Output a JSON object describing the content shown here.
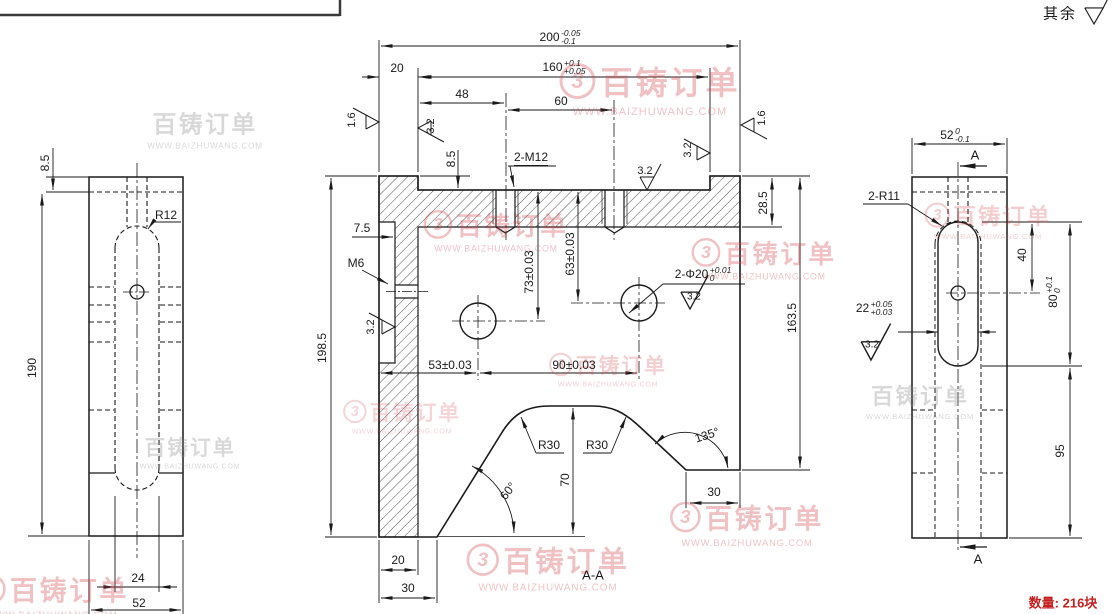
{
  "note": {
    "text": "其余"
  },
  "quantity": {
    "label": "数量: 216块"
  },
  "watermark": {
    "brand": "百铸订单",
    "url": "WWW.BAIZHUWANG.COM",
    "logo": "3"
  },
  "left_view": {
    "dim_8_5": "8.5",
    "dim_190": "190",
    "label_r12": "R12",
    "dim_24": "24",
    "dim_52": "52"
  },
  "main_view": {
    "dim_200": {
      "v": "200",
      "t1": "-0.05",
      "t2": "-0.1"
    },
    "dim_160": {
      "v": "160",
      "t1": "+0.1",
      "t2": "+0.05"
    },
    "dim_20_top": "20",
    "dim_48": "48",
    "dim_60": "60",
    "label_2m12": "2-M12",
    "dim_8_5": "8.5",
    "dim_28_5": "28.5",
    "dim_163_5": "163.5",
    "dim_198_5": "198.5",
    "dim_7_5": "7.5",
    "label_m6": "M6",
    "dim_73": "73±0.03",
    "dim_63": "63±0.03",
    "label_2phi20": {
      "v": "2-Φ20",
      "t1": "+0.01",
      "t2": "0"
    },
    "dim_53": "53±0.03",
    "dim_90": "90±0.03",
    "label_r30_1": "R30",
    "label_r30_2": "R30",
    "dim_60deg": "60°",
    "dim_135deg": "135°",
    "dim_70": "70",
    "dim_30_right": "30",
    "dim_20_bottom": "20",
    "dim_30_bottom": "30",
    "section_label": "A-A",
    "finish_1_6_left": "1.6",
    "finish_3_2_a": "3.2",
    "finish_3_2_b": "3.2",
    "finish_3_2_c": "3.2",
    "finish_1_6_right": "1.6",
    "finish_3_2_left_col": "3.2",
    "finish_3_2_hole": "3.2"
  },
  "right_view": {
    "dim_52": {
      "v": "52",
      "t1": "0",
      "t2": "-0.1"
    },
    "label_a_top": "A",
    "label_a_bottom": "A",
    "label_2r11": "2-R11",
    "dim_40": "40",
    "dim_80": {
      "v": "80",
      "t1": "+0.1",
      "t2": "0"
    },
    "dim_22": {
      "v": "22",
      "t1": "+0.05",
      "t2": "+0.03"
    },
    "finish_3_2": "3.2",
    "dim_95": "95"
  }
}
